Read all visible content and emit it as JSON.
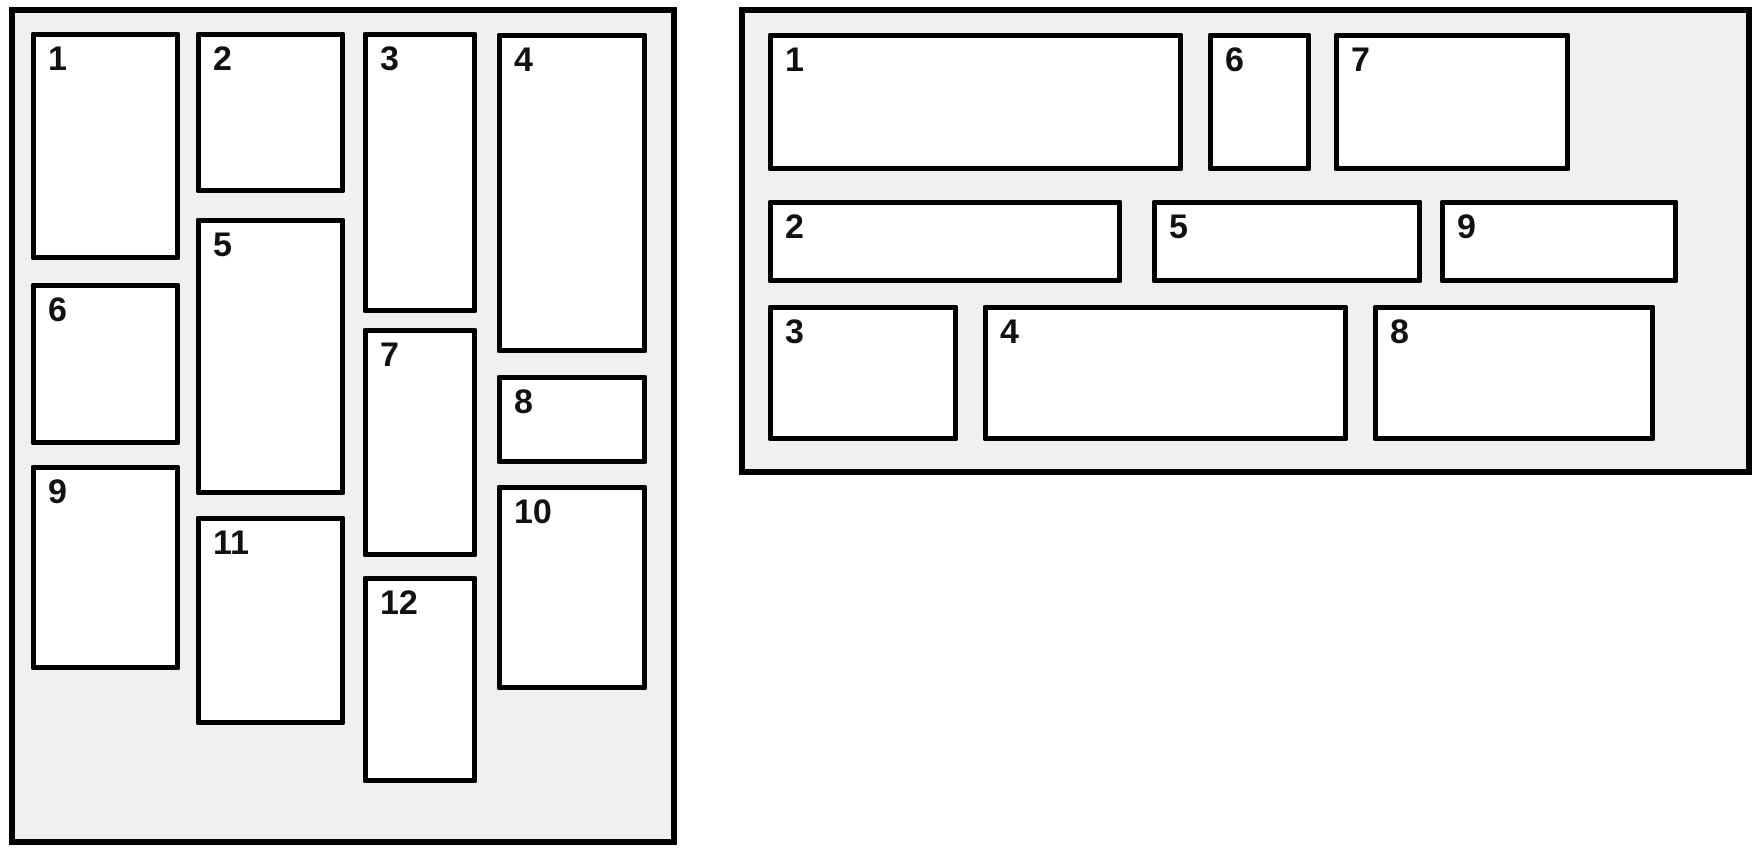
{
  "colors": {
    "page_background": "#ffffff",
    "panel_background": "#f0f0f0",
    "panel_border": "#000000",
    "card_background": "#ffffff",
    "card_border": "#000000",
    "label_color": "#111111"
  },
  "panels": [
    {
      "id": "masonry-panel",
      "layout": "masonry-columns",
      "cards": [
        {
          "label": "1"
        },
        {
          "label": "2"
        },
        {
          "label": "3"
        },
        {
          "label": "4"
        },
        {
          "label": "5"
        },
        {
          "label": "6"
        },
        {
          "label": "7"
        },
        {
          "label": "8"
        },
        {
          "label": "9"
        },
        {
          "label": "10"
        },
        {
          "label": "11"
        },
        {
          "label": "12"
        }
      ]
    },
    {
      "id": "rows-panel",
      "layout": "horizontal-rows",
      "cards": [
        {
          "label": "1"
        },
        {
          "label": "2"
        },
        {
          "label": "3"
        },
        {
          "label": "4"
        },
        {
          "label": "5"
        },
        {
          "label": "6"
        },
        {
          "label": "7"
        },
        {
          "label": "8"
        },
        {
          "label": "9"
        }
      ]
    }
  ]
}
